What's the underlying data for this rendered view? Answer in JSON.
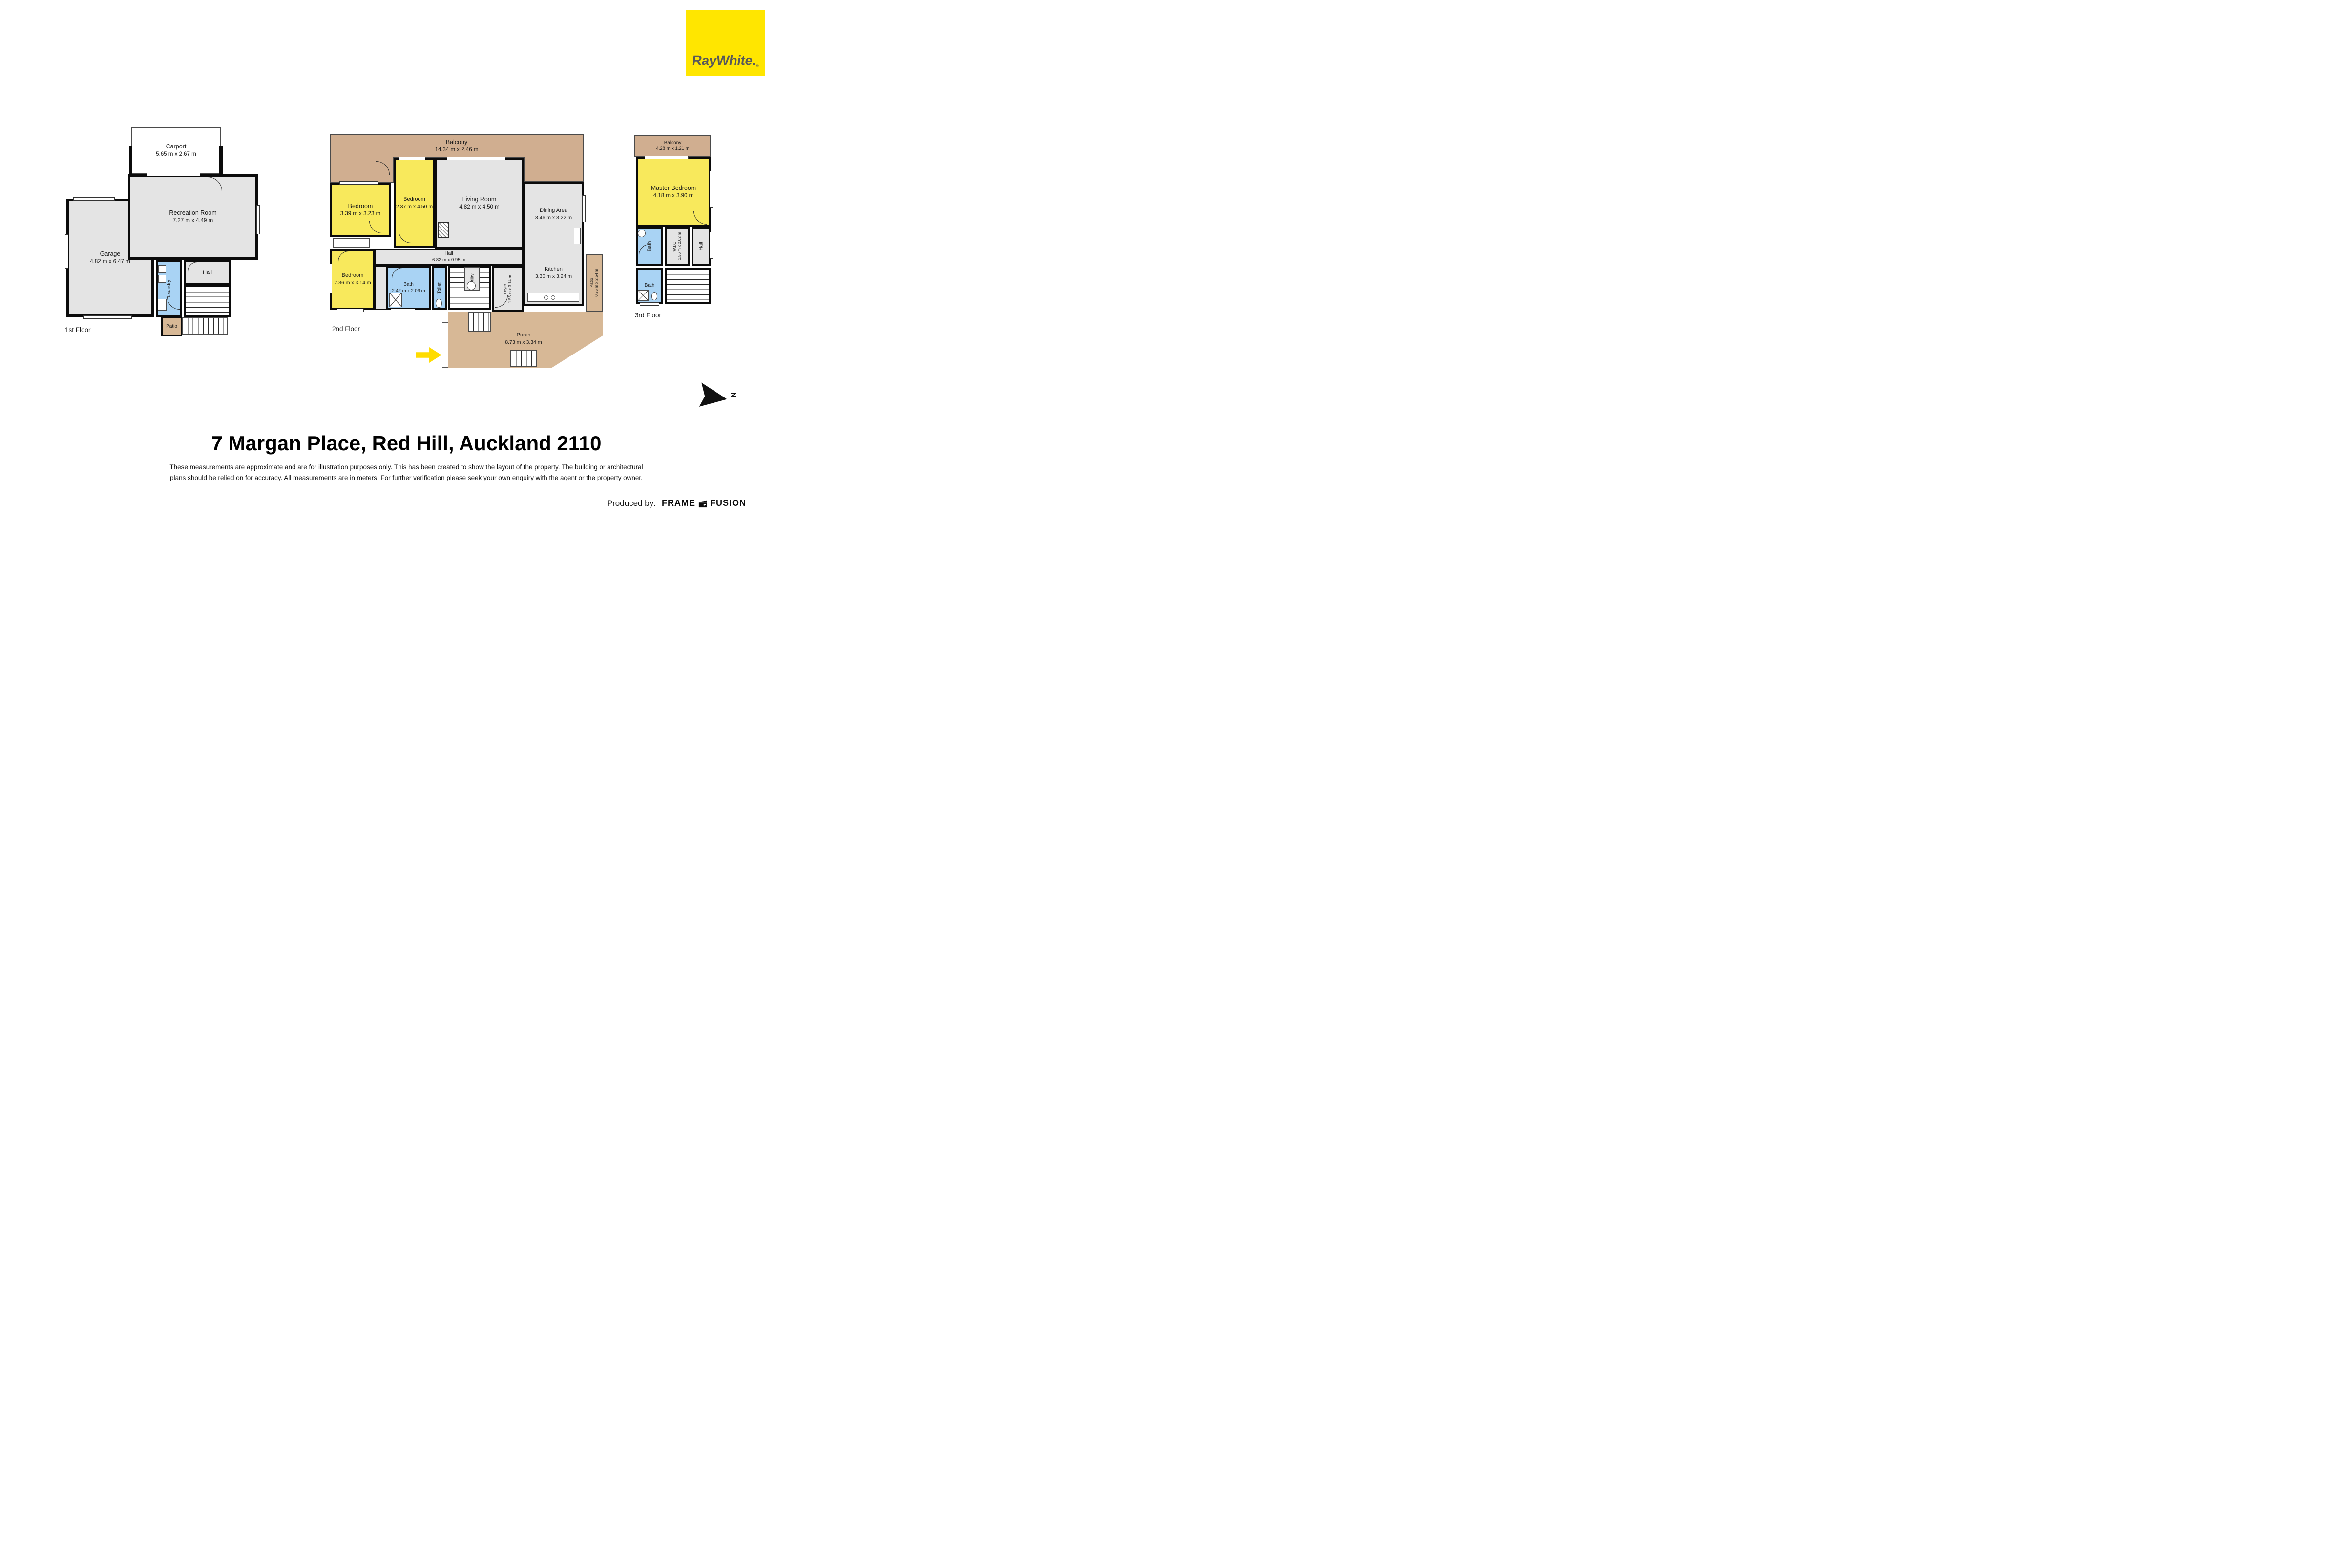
{
  "colors": {
    "brand_yellow": "#FFE600",
    "brand_text_gray": "#58595B",
    "room_yellow": "#F8E95C",
    "room_gray": "#E4E4E4",
    "room_blue": "#A9D3F4",
    "balcony_tan": "#D0AE90",
    "porch_tan": "#D7B896",
    "wall_black": "#0B0B0B",
    "entry_arrow_yellow": "#FFDC00"
  },
  "branding": {
    "logo_text": "RayWhite.",
    "logo_reg": "®",
    "produced_by_label": "Produced by:",
    "producer_word1": "FRAME",
    "producer_word2": "FUSION"
  },
  "header": {
    "title": "7 Margan Place, Red Hill, Auckland 2110"
  },
  "disclaimer": {
    "line1": "These measurements are approximate and are for illustration purposes only. This has been created to show the layout of the property. The building or architectural",
    "line2": "plans should be relied on for accuracy. All measurements are in meters. For further verification please seek your own enquiry with the agent or the property owner."
  },
  "compass": {
    "north_label": "N"
  },
  "floor1": {
    "label": "1st Floor",
    "rooms": {
      "carport": {
        "name": "Carport",
        "dims": "5.65 m x 2.67 m"
      },
      "recreation": {
        "name": "Recreation Room",
        "dims": "7.27 m x 4.49 m"
      },
      "garage": {
        "name": "Garage",
        "dims": "4.82 m x 6.47 m"
      },
      "hall": {
        "name": "Hall"
      },
      "laundry": {
        "name": "Laundry"
      },
      "patio": {
        "name": "Patio"
      }
    }
  },
  "floor2": {
    "label": "2nd Floor",
    "rooms": {
      "balcony": {
        "name": "Balcony",
        "dims": "14.34 m x 2.46 m"
      },
      "bedroom_a": {
        "name": "Bedroom",
        "dims": "3.39 m x 3.23 m"
      },
      "bedroom_b": {
        "name": "Bedroom",
        "dims": "2.37 m x 4.50 m"
      },
      "living_room": {
        "name": "Living Room",
        "dims": "4.82 m x 4.50 m"
      },
      "dining_area": {
        "name": "Dining Area",
        "dims": "3.46 m x 3.22 m"
      },
      "bedroom_c": {
        "name": "Bedroom",
        "dims": "2.36 m x 3.14 m"
      },
      "hall": {
        "name": "Hall",
        "dims": "6.82 m x 0.95 m"
      },
      "bath": {
        "name": "Bath",
        "dims": "2.42 m x 2.09 m"
      },
      "toilet": {
        "name": "Toilet"
      },
      "utility": {
        "name": "Utility"
      },
      "foyer": {
        "name": "Foyer",
        "dims": "1.55 m x 3.14 m"
      },
      "kitchen": {
        "name": "Kitchen",
        "dims": "3.30 m x 3.24 m"
      },
      "patio": {
        "name": "Patio",
        "dims": "0.95 m x 2.54 m"
      },
      "porch": {
        "name": "Porch",
        "dims": "8.73 m x 3.34 m"
      }
    }
  },
  "floor3": {
    "label": "3rd Floor",
    "rooms": {
      "balcony": {
        "name": "Balcony",
        "dims": "4.28 m x 1.21 m"
      },
      "master_bedroom": {
        "name": "Master Bedroom",
        "dims": "4.18 m x 3.90 m"
      },
      "bath_upper": {
        "name": "Bath"
      },
      "wic": {
        "name": "W.I.C.",
        "dims": "1.56 m x 2.02 m"
      },
      "hall": {
        "name": "Hall"
      },
      "bath_lower": {
        "name": "Bath"
      }
    }
  }
}
